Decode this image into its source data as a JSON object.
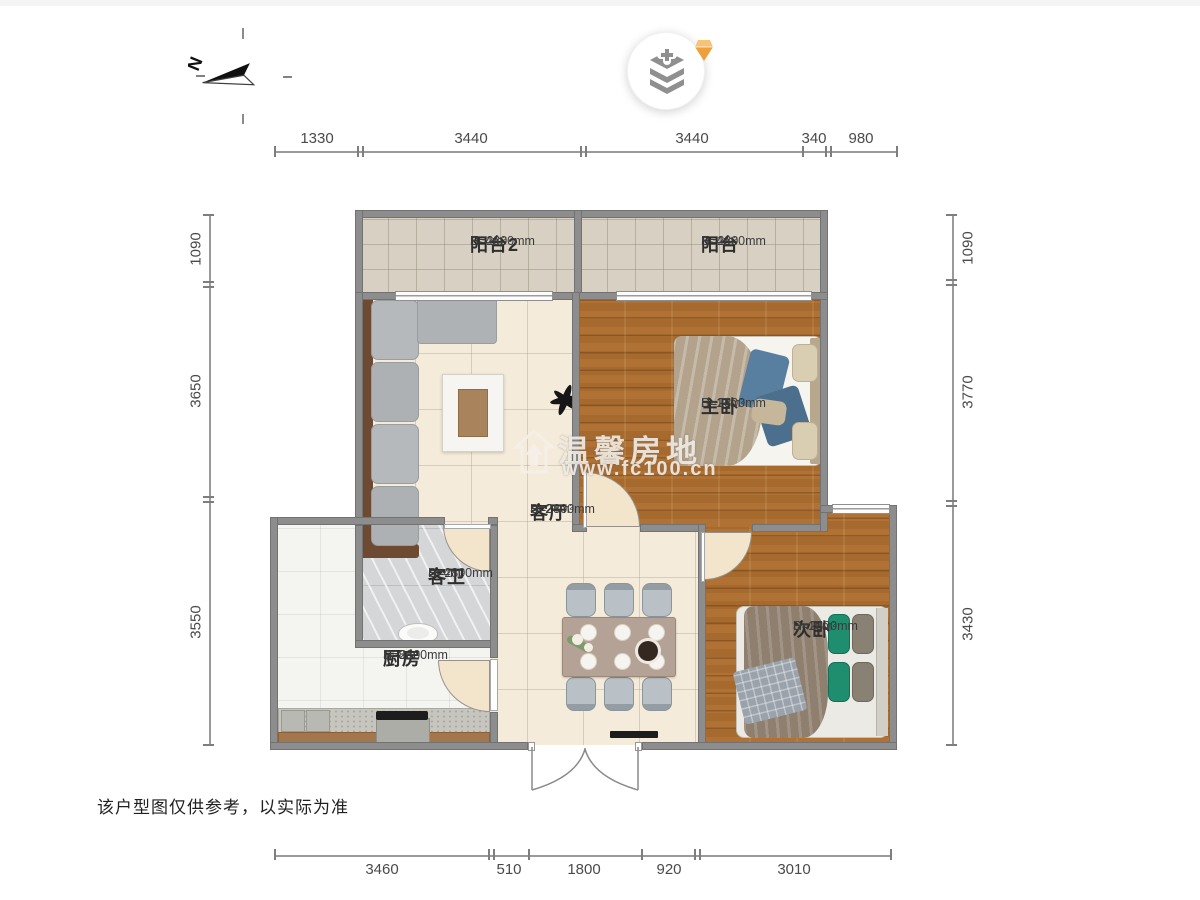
{
  "page": {
    "disclaimer": "该户型图仅供参考，以实际为准"
  },
  "compass": {
    "label": "N"
  },
  "watermark": {
    "brand": "温馨房地",
    "url": "www.fc100.cn"
  },
  "icons": {
    "layers": "add-layers-icon",
    "gem": "gem-icon",
    "compass": "north-arrow-icon",
    "watermark_house": "house-icon",
    "plant": "plant-silhouette-icon"
  },
  "dimensions": {
    "top": [
      "1330",
      "3440",
      "3440",
      "340",
      "980"
    ],
    "bottom": [
      "3460",
      "510",
      "1800",
      "920",
      "3010"
    ],
    "left": [
      "1090",
      "3650",
      "3550"
    ],
    "right": [
      "1090",
      "3770",
      "3430"
    ]
  },
  "rooms": {
    "balcony2": {
      "name": "阳台2",
      "height": "H=2800mm",
      "area": "S≈4m²"
    },
    "balcony": {
      "name": "阳台",
      "height": "H=2800mm",
      "area": "S≈4m²"
    },
    "master": {
      "name": "主卧",
      "height": "H=2800mm",
      "area": "S≈14m²"
    },
    "living": {
      "name": "客厅",
      "height": "H=2800mm",
      "area": "S≈24m²"
    },
    "bathroom": {
      "name": "客卫",
      "height": "H=2800mm",
      "area": "S≈4m²"
    },
    "kitchen": {
      "name": "厨房",
      "height": "H=2800mm",
      "area": "S≈8m²"
    },
    "bedroom2": {
      "name": "次卧",
      "height": "H=2800mm",
      "area": "S≈10m²"
    }
  },
  "colors": {
    "wall": "#8d8d8d",
    "wood_floor": "#a76a2e",
    "tile_floor": "#f4ebda",
    "balcony_floor": "#d8d1c3",
    "gem_accent": "#f0a93f"
  }
}
